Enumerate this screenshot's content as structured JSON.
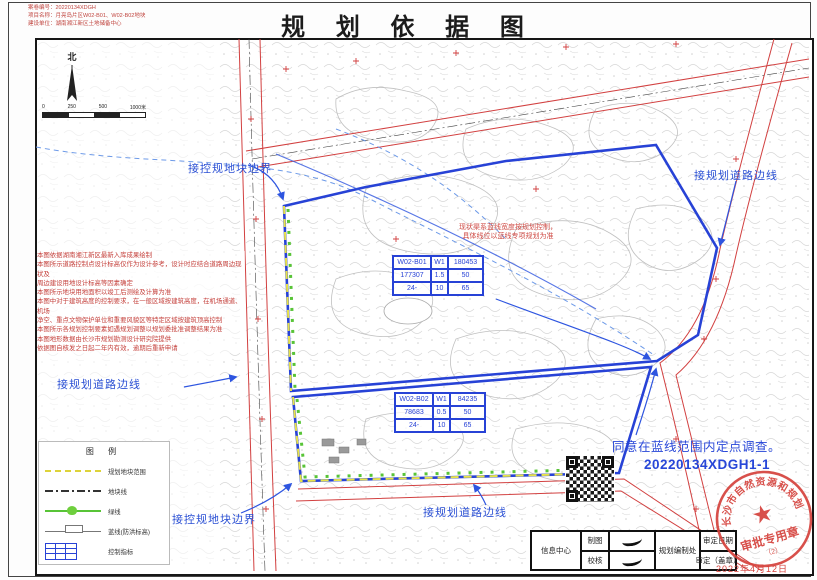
{
  "meta": {
    "line1": "案卷编号：20220134XDGH",
    "line2": "项目名称：月亮岛片区W02-B01、W02-B02地块",
    "line3": "建设单位：湖南湘江新区土地储备中心"
  },
  "title": "规 划 依 据 图",
  "compass_label": "北",
  "scalebar": {
    "t0": "0",
    "t1": "250",
    "t2": "500",
    "t3": "1000米"
  },
  "notes": [
    "本图依据湖南湘江新区最新入库成果绘制",
    "本图所示道路控制点设计标高仅作为设计参考，设计时应结合道路周边现状及",
    "周边建设用地设计标高等因素确定",
    "本图所示地块用地面积以竣工后测绘及计算为准",
    "本图中对于建筑高度的控制要求，在一般区域按建筑高度，在机场通道、机场",
    "净空、重点文物保护单位和重要风貌区等特定区域按建筑顶高控制",
    "本图所示各规划控制要素如遇规划调整以规划委批准调整结果为准",
    "本图地形数据由长沙市规划勘测设计研究院提供",
    "依据图自核发之日起二年内有效，逾期后重新申请"
  ],
  "labels": {
    "top_boundary": "接控规地块边界",
    "top_right_road": "接规划道路边线",
    "left_road": "接规划道路边线",
    "bottom_boundary": "接控规地块边界",
    "bottom_road": "接规划道路边线",
    "red_note1": "现状渠系蓝线宽度按规划控制，",
    "red_note2": "具体线位以蓝线专项规划为准",
    "approval1": "同意在蓝线范围内定点调查。",
    "approval2": "20220134XDGH1-1"
  },
  "parcel_tables": [
    {
      "rows": [
        [
          "W02-B01",
          "W1",
          "180453"
        ],
        [
          "177307",
          "1.5",
          "50"
        ],
        [
          "24-",
          "10",
          "65"
        ]
      ]
    },
    {
      "rows": [
        [
          "W02-B02",
          "W1",
          "84235"
        ],
        [
          "78683",
          "0.5",
          "50"
        ],
        [
          "24-",
          "10",
          "65"
        ]
      ]
    }
  ],
  "legend": {
    "title": "图 例",
    "items": [
      {
        "label": "规划地块范围"
      },
      {
        "label": "地块线"
      },
      {
        "label": "绿线"
      },
      {
        "label": "蓝线(防洪标高)"
      },
      {
        "label": "控制指标"
      }
    ]
  },
  "footer": {
    "info_center": "信息中心",
    "draft": "制图",
    "check": "校核",
    "dept": "规划编制处",
    "date_label": "审定日期",
    "seal_label": "审定（盖章）"
  },
  "stamp": {
    "ring": "长沙市自然资源和规划局",
    "center": "审批专用章",
    "sub": "（2）",
    "date": "2022年4月12日"
  },
  "colors": {
    "red": "#cf3332",
    "blue": "#2742d6",
    "light_blue": "#6d9ae8",
    "yellow": "#e8e24a",
    "green": "#58c437"
  }
}
